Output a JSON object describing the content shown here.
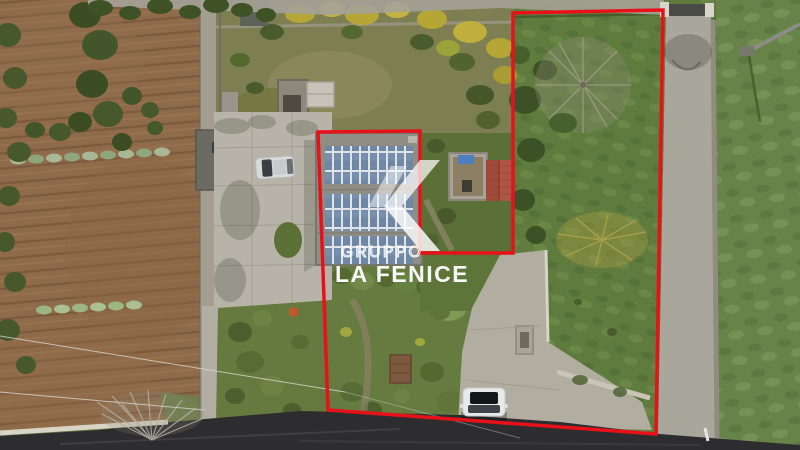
{
  "watermark": {
    "brand_top": "GRUPPO",
    "brand_bottom": "LA FENICE",
    "text_color": "#ffffff"
  },
  "boundary": {
    "color": "#e8111a",
    "points": "513,13 663,10 656,434 328,410 318,132 420,131 420,253 513,253",
    "stroke_width": "3.5"
  },
  "palette": {
    "field_brown": "#8f6b4a",
    "plow_shadow": "#7d5a3e",
    "grass_green": "#5f7c3e",
    "meadow_green": "#68834a",
    "scrub_green": "#5e7440",
    "concrete": "#b8b3a8",
    "apron_concrete": "#b2ada1",
    "driveway_concrete": "#a9a69c",
    "asphalt": "#2d2d30",
    "solar_panel_blue": "#6f87a3",
    "shed_roof_red": "#a04a3c",
    "wall_white": "#d9d4c6"
  }
}
